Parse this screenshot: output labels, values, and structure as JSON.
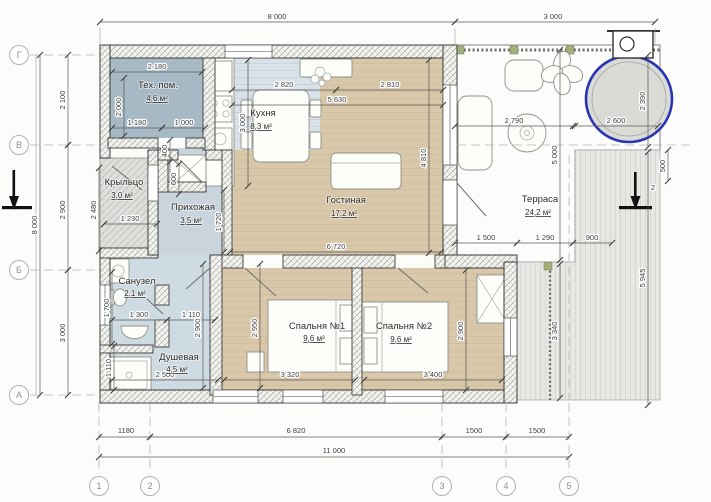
{
  "plan": {
    "title": "floor-plan",
    "colors": {
      "accent_blue": "#2b35b4",
      "room_tan": "#d8c7a9",
      "room_wet": "#cfdbe2",
      "room_tech": "#a8b9c6",
      "deck_gray": "#d8d8d4"
    },
    "axes": {
      "rows": [
        "Г",
        "В",
        "Б",
        "А"
      ],
      "cols": [
        "1",
        "2",
        "3",
        "4",
        "5"
      ]
    },
    "rooms": [
      {
        "name": "Тех. пом.",
        "area": "4,6 м²"
      },
      {
        "name": "Кухня",
        "area": "8,3 м²"
      },
      {
        "name": "Гостиная",
        "area": "17,2 м²"
      },
      {
        "name": "Крыльцо",
        "area": "3,0 м²"
      },
      {
        "name": "Прихожая",
        "area": "3,5 м²"
      },
      {
        "name": "Терраса",
        "area": "24,2 м²"
      },
      {
        "name": "Санузел",
        "area": "2,1 м²"
      },
      {
        "name": "Душевая",
        "area": "4,5 м²"
      },
      {
        "name": "Спальня №1",
        "area": "9,6 м²"
      },
      {
        "name": "Спальня №2",
        "area": "9,6 м²"
      }
    ],
    "dims": {
      "top_main": "8 000",
      "top_terrace": "3 000",
      "left_total": "8 000",
      "left_gv": "2 100",
      "left_vb": "2 900",
      "left_ba": "3 000",
      "bottom_12": "1180",
      "bottom_23": "6 820",
      "bottom_34": "1500",
      "bottom_45": "1500",
      "bottom_total": "11 000",
      "right_total": "5 945",
      "right_500": "500",
      "section_mark": "2",
      "tech_w": "2 180",
      "tech_h": "2 000",
      "tech_1180": "1 180",
      "tech_1000": "1 000",
      "tech_400": "400",
      "tech_600": "600",
      "porch_h": "2 480",
      "porch_w": "1 230",
      "kitchen_w": "2 820",
      "kitchen_h": "3 000",
      "living_top": "2 810",
      "living_w": "5 630",
      "living_h": "4 810",
      "living_bottom": "6 720",
      "hall_h": "1 720",
      "wc_h": "1 700",
      "wc_1300": "1 300",
      "wc_1110": "1 110",
      "shower_h": "2 900",
      "shower_1110": "1 110",
      "shower_w": "2 500",
      "bed1_h": "2 950",
      "bed1_w": "3 320",
      "bed2_h": "2 900",
      "bed2_w": "3 400",
      "terrace_w": "2 790",
      "terrace_h": "5 000",
      "terrace_1500": "1 500",
      "terrace_1290": "1 290",
      "terrace_900": "900",
      "terrace_3340": "3 340",
      "tub_w": "2 600",
      "tub_h": "2 390"
    }
  }
}
